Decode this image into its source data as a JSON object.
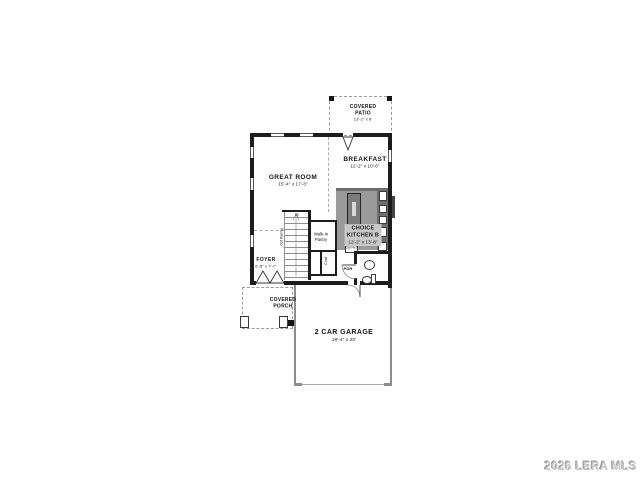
{
  "watermark": "2026 LERA MLS",
  "rooms": {
    "covered_patio": {
      "name": "COVERED PATIO",
      "dim": "13'-2\" x 8'"
    },
    "breakfast": {
      "name": "BREAKFAST",
      "dim": "12'-2\" x 10'-6\""
    },
    "great_room": {
      "name": "GREAT ROOM",
      "dim": "15'-4\" x 17'-3\""
    },
    "kitchen": {
      "name": "CHOICE KITCHEN B",
      "dim": "12'-2\" x 13'-8\""
    },
    "foyer": {
      "name": "FOYER",
      "dim": "6'-8\" x 7'-7\""
    },
    "covered_porch": {
      "name": "COVERED PORCH"
    },
    "garage": {
      "name": "2 CAR GARAGE",
      "dim": "19'-4\" x 20'"
    },
    "walk_in_pantry": {
      "name": "Walk-In Pantry"
    },
    "coat_closet": {
      "name": "Coat"
    },
    "powder_room": {
      "name": "PDR"
    }
  },
  "annotations": {
    "stairs_up": "Up",
    "opt_railing": "Opt Railing",
    "opt_ref": "Opt Ref"
  }
}
